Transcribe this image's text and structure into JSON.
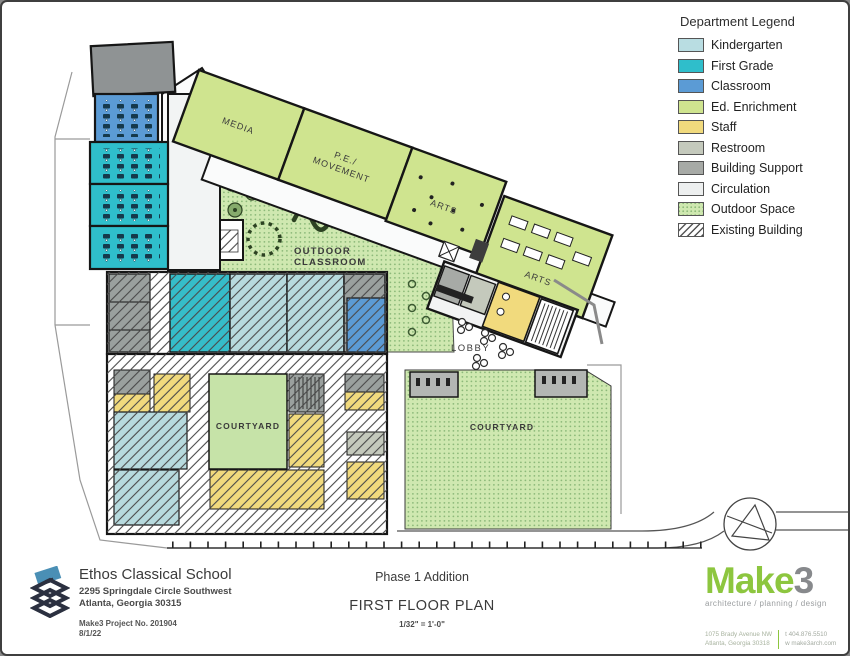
{
  "legend": {
    "title": "Department Legend",
    "items": [
      {
        "label": "Kindergarten",
        "color": "#b9dde2",
        "pattern": "solid"
      },
      {
        "label": "First Grade",
        "color": "#2fbecb",
        "pattern": "solid"
      },
      {
        "label": "Classroom",
        "color": "#5b9bd5",
        "pattern": "solid"
      },
      {
        "label": "Ed. Enrichment",
        "color": "#cfe48f",
        "pattern": "solid"
      },
      {
        "label": "Staff",
        "color": "#f1da7d",
        "pattern": "solid"
      },
      {
        "label": "Restroom",
        "color": "#c4c9bc",
        "pattern": "solid"
      },
      {
        "label": "Building Support",
        "color": "#a7aaa6",
        "pattern": "solid"
      },
      {
        "label": "Circulation",
        "color": "#edefef",
        "pattern": "solid"
      },
      {
        "label": "Outdoor Space",
        "color": "#cfe8b0",
        "pattern": "dots"
      },
      {
        "label": "Existing Building",
        "color": "#ffffff",
        "pattern": "hatch"
      }
    ]
  },
  "plan": {
    "labels": {
      "media": "MEDIA",
      "pe_line1": "P.E./",
      "pe_line2": "MOVEMENT",
      "arts": "ARTS",
      "outdoor_line1": "OUTDOOR",
      "outdoor_line2": "CLASSROOM",
      "lobby": "LOBBY",
      "courtyard": "COURTYARD"
    }
  },
  "titleblock": {
    "school": {
      "name": "Ethos Classical School",
      "address1": "2295 Springdale Circle Southwest",
      "address2": "Atlanta, Georgia 30315",
      "project": "Make3 Project No. 201904",
      "date": "8/1/22"
    },
    "center": {
      "phase": "Phase 1 Addition",
      "title": "FIRST FLOOR PLAN",
      "scale": "1/32\" = 1'-0\""
    },
    "firm": {
      "name_green": "Make",
      "name_gray": "3",
      "tagline": "architecture / planning / design",
      "address1": "1075 Brady Avenue NW",
      "address2": "Atlanta, Georgia 30318",
      "phone": "t  404.876.5510",
      "web": "w  make3arch.com",
      "accent_green": "#8dc63f"
    }
  }
}
